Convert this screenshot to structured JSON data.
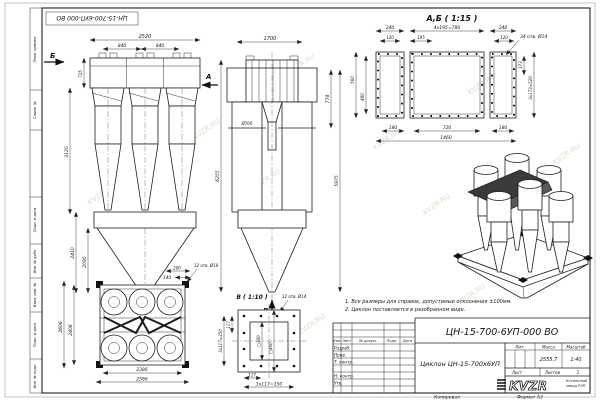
{
  "frame": {
    "stamp_rotated": "ЦН-15-700-6УП-000 ВО",
    "copied_label": "Копировал",
    "format_label": "Формат А3",
    "watermark": "KVZR.RU",
    "margin_labels": {
      "perv": "Перв. примен.",
      "sprav": "Справ. №",
      "podp1": "Подп. и дата",
      "inv_dubl": "Инв. № дубл.",
      "vzam": "Взам. инв. №",
      "podp2": "Подп. и дата",
      "inv_podl": "Инв. № подл."
    }
  },
  "views": {
    "left": {
      "arrow_b": "Б",
      "arrow_a": "А",
      "dim_2520": "2520",
      "dim_840a": "840",
      "dim_840b": "840",
      "dim_725": "725",
      "dim_3120": "3120",
      "dim_2410": "2410",
      "dim_2095": "2095"
    },
    "front": {
      "dim_1700": "1700",
      "dim_774": "774",
      "dim_6255": "6255",
      "dim_5975": "5975",
      "dim_d700": "Ø700",
      "arrow_v": "В"
    },
    "section_ab": {
      "title": "А,Б ( 1:15 )",
      "dim_240a": "240",
      "dim_780": "4х195=780",
      "dim_240b": "240",
      "dim_120a": "120",
      "dim_195": "195",
      "dim_120b": "120",
      "holes": "34 отв. Ø14",
      "dim_173": "173",
      "dim_520": "3х173=520",
      "dim_560": "560",
      "dim_460": "460",
      "dim_180a": "180",
      "dim_720": "720",
      "dim_180b": "180",
      "dim_1460": "1460"
    },
    "plan": {
      "dim_2606": "2606",
      "dim_2406": "2406",
      "dim_2386": "2386",
      "dim_2586": "2586",
      "dim_200": "200",
      "dim_140": "140",
      "holes": "12 отв. Ø18"
    },
    "flange_v": {
      "title": "В ( 1:10 )",
      "holes": "12 отв. Ø14",
      "dim_sq300": "□300",
      "dim_sq400": "□400",
      "dim_117b": "117",
      "dim_350b": "3х117=350",
      "dim_117l": "117",
      "dim_350l": "3х117=350"
    }
  },
  "notes": {
    "line1": "1. Все размеры для справок, допустимые отклонения ±100мм.",
    "line2": "2. Циклон поставляется в разобранном виде."
  },
  "title_block": {
    "doc_number": "ЦН-15-700-6УП-000 ВО",
    "product_name": "Циклон ЦН-15-700х6УП",
    "col_izm": "Изм.",
    "col_list": "Лист",
    "col_doc": "№ докум.",
    "col_podp": "Подп.",
    "col_data": "Дата",
    "row_razrab": "Разраб.",
    "row_prov": "Пров.",
    "row_tkontr": "Т. контр.",
    "row_nkontr": "Н. контр.",
    "row_utv": "Утв.",
    "lit_label": "Лит.",
    "mass_label": "Масса",
    "scale_label": "Масштаб",
    "mass_value": "2555,7",
    "scale_value": "1:40",
    "sheet_label": "Лист",
    "sheets_label": "Листов",
    "sheets_value": "1",
    "logo_text": "KVZR",
    "company_line1": "Котельный",
    "company_line2": "завод РЭП"
  }
}
